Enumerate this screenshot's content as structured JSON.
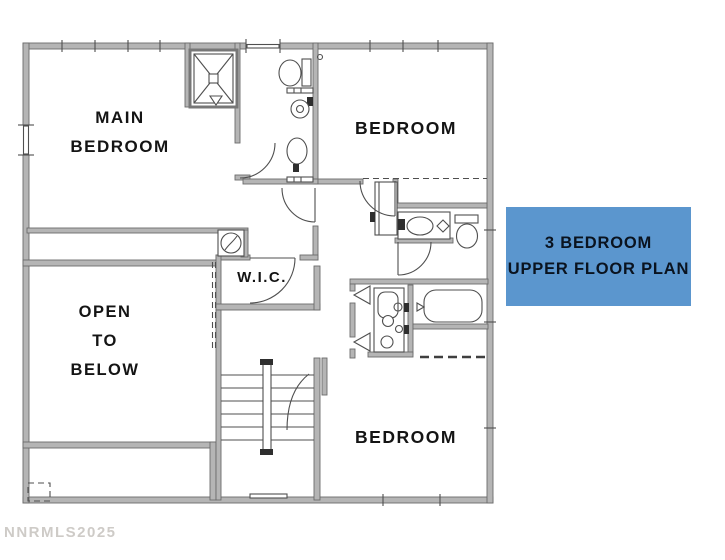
{
  "image": {
    "width": 725,
    "height": 560,
    "background": "#ffffff"
  },
  "floor_plan": {
    "rooms": {
      "main_bedroom": {
        "line1": "MAIN",
        "line2": "BEDROOM"
      },
      "bedroom_upper_right": {
        "label": "BEDROOM"
      },
      "wic": {
        "label": "W.I.C."
      },
      "open_to_below": {
        "line1": "OPEN",
        "line2": "TO",
        "line3": "BELOW"
      },
      "bedroom_lower_right": {
        "label": "BEDROOM"
      }
    },
    "fixtures": [
      "shower",
      "toilet",
      "sink",
      "vanity",
      "double-vanity",
      "bathtub",
      "staircase",
      "linen-closet",
      "door-swing"
    ],
    "colors": {
      "wall": "#b5b5b5",
      "line": "#4f4f4f",
      "label_text": "#141414"
    }
  },
  "title_card": {
    "line1": "3 BEDROOM",
    "line2": "UPPER FLOOR PLAN",
    "background_color": "#5b96ce",
    "text_color": "#0a131f"
  },
  "watermark": {
    "text": "NNRMLS2025",
    "color": "#c6c2be"
  }
}
